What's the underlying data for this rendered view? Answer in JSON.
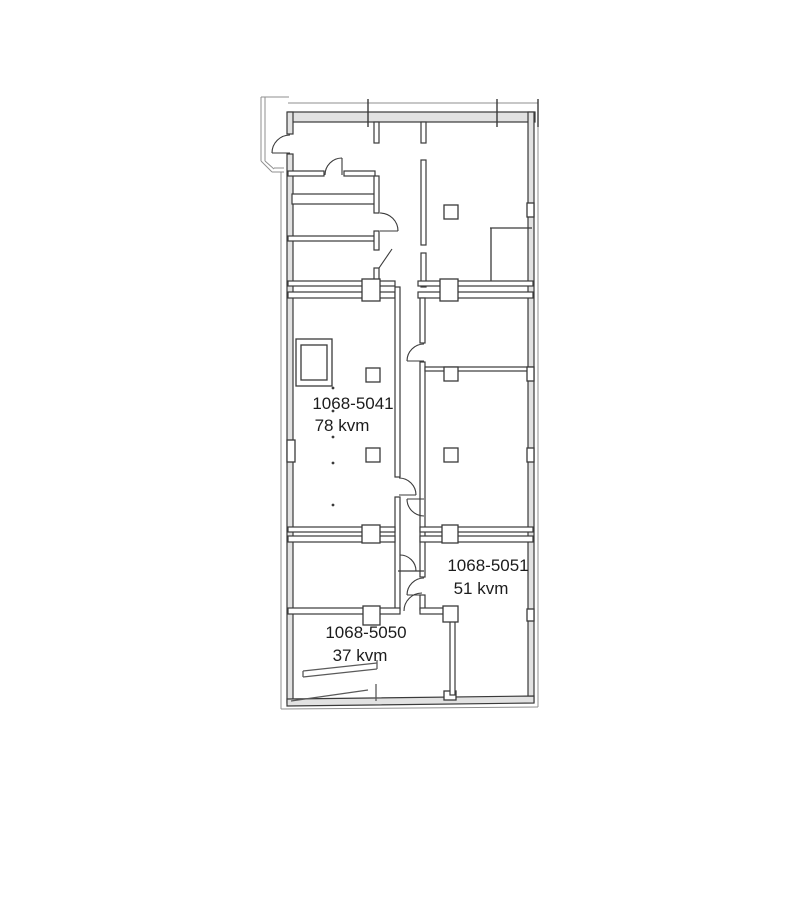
{
  "page": {
    "background": "#ffffff"
  },
  "plan": {
    "type": "floor-plan",
    "colors": {
      "background": "#ffffff",
      "wall_dark": "#3a3a3a",
      "wall_mid": "#5a5a5a",
      "wall_fill": "#e2e2e2",
      "outline": "#8f8f8f",
      "text": "#1c1c1c"
    },
    "rooms": [
      {
        "id": "1068-5041",
        "area": "78 kvm"
      },
      {
        "id": "1068-5051",
        "area": "51 kvm"
      },
      {
        "id": "1068-5050",
        "area": "37 kvm"
      }
    ]
  }
}
